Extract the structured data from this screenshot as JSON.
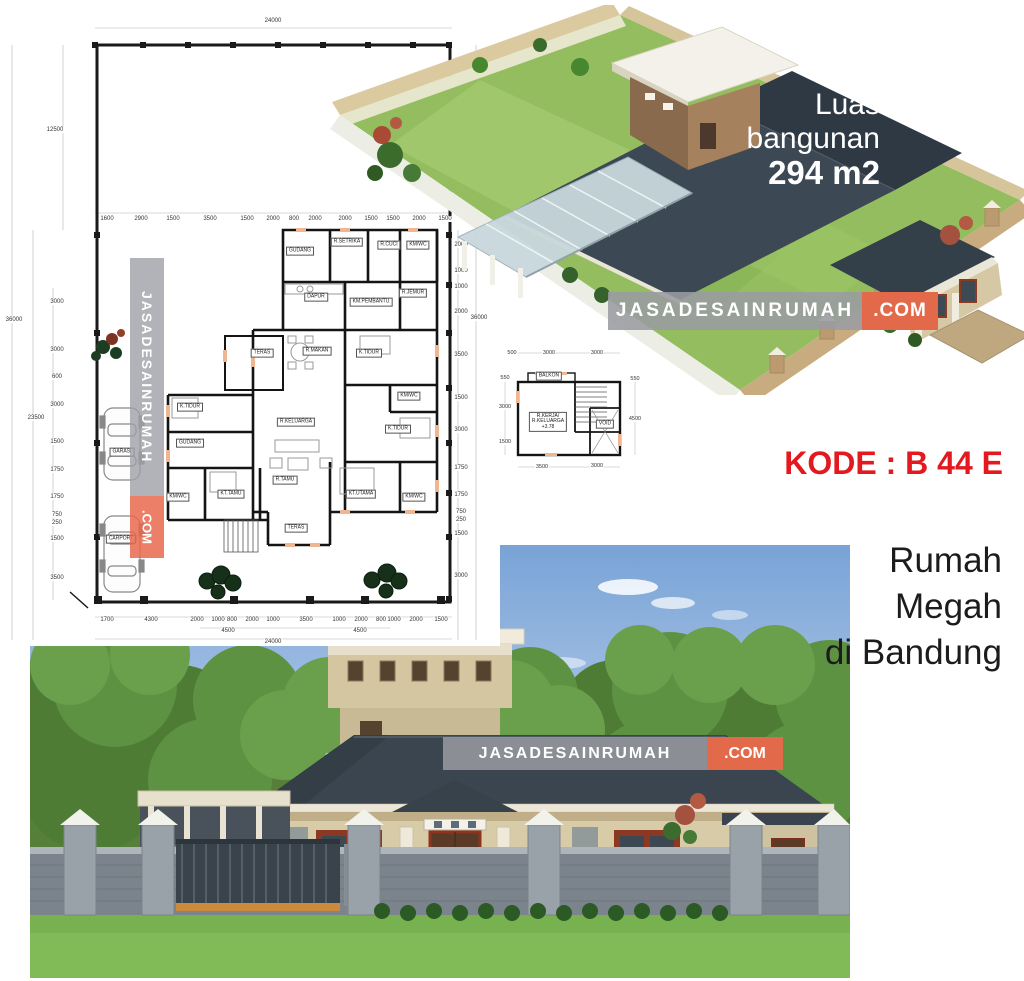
{
  "brand": {
    "name": "JASADESAINRUMAH",
    "tld": ".COM",
    "bar_gray": "#9a9ca2",
    "bar_orange": "#e26a4a"
  },
  "aerial_overlay": {
    "line1": "Luas",
    "line2": "bangunan",
    "line3": "294 m2"
  },
  "code_label": "KODE : B 44 E",
  "code_color": "#e3191f",
  "title_lines": [
    "Rumah",
    "Megah",
    "di Bandung"
  ],
  "main_plan": {
    "rooms": [
      {
        "label": "GUDANG",
        "x": 300,
        "y": 251
      },
      {
        "label": "R.SETRIKA",
        "x": 347,
        "y": 242
      },
      {
        "label": "R.CUCI",
        "x": 389,
        "y": 245
      },
      {
        "label": "KM/WC",
        "x": 418,
        "y": 245
      },
      {
        "label": "DAPUR",
        "x": 316,
        "y": 297
      },
      {
        "label": "KM.PEMBANTU",
        "x": 371,
        "y": 302
      },
      {
        "label": "R.JEMUR",
        "x": 413,
        "y": 293
      },
      {
        "label": "TERAS",
        "x": 262,
        "y": 353
      },
      {
        "label": "R.MAKAN",
        "x": 317,
        "y": 351
      },
      {
        "label": "K.TIDUR",
        "x": 369,
        "y": 353
      },
      {
        "label": "KM/WC",
        "x": 409,
        "y": 396
      },
      {
        "label": "R.KELUARGA",
        "x": 296,
        "y": 422
      },
      {
        "label": "K.TIDUR",
        "x": 398,
        "y": 429
      },
      {
        "label": "K.TIDUR",
        "x": 190,
        "y": 407
      },
      {
        "label": "GUDANG",
        "x": 190,
        "y": 443
      },
      {
        "label": "KM/WC",
        "x": 178,
        "y": 497
      },
      {
        "label": "KT.TAMU",
        "x": 231,
        "y": 494
      },
      {
        "label": "R.TAMU",
        "x": 285,
        "y": 480
      },
      {
        "label": "KT.UTAMA",
        "x": 361,
        "y": 494
      },
      {
        "label": "KM/WC",
        "x": 414,
        "y": 497
      },
      {
        "label": "TERAS",
        "x": 296,
        "y": 528
      },
      {
        "label": "GARASI",
        "x": 122,
        "y": 452
      },
      {
        "label": "CARPORT",
        "x": 121,
        "y": 539
      }
    ],
    "dims": [
      {
        "label": "24000",
        "x": 273,
        "y": 21
      },
      {
        "label": "1600",
        "x": 107,
        "y": 219
      },
      {
        "label": "2900",
        "x": 141,
        "y": 219
      },
      {
        "label": "1500",
        "x": 173,
        "y": 219
      },
      {
        "label": "3500",
        "x": 210,
        "y": 219
      },
      {
        "label": "1500",
        "x": 247,
        "y": 219
      },
      {
        "label": "2000",
        "x": 273,
        "y": 219
      },
      {
        "label": "800",
        "x": 294,
        "y": 219
      },
      {
        "label": "2000",
        "x": 315,
        "y": 219
      },
      {
        "label": "2000",
        "x": 345,
        "y": 219
      },
      {
        "label": "1500",
        "x": 371,
        "y": 219
      },
      {
        "label": "1500",
        "x": 393,
        "y": 219
      },
      {
        "label": "2000",
        "x": 419,
        "y": 219
      },
      {
        "label": "1500",
        "x": 445,
        "y": 219
      },
      {
        "label": "12500",
        "x": 55,
        "y": 130
      },
      {
        "label": "36000",
        "x": 14,
        "y": 320
      },
      {
        "label": "23500",
        "x": 36,
        "y": 418
      },
      {
        "label": "3000",
        "x": 57,
        "y": 302
      },
      {
        "label": "3000",
        "x": 57,
        "y": 350
      },
      {
        "label": "600",
        "x": 57,
        "y": 377
      },
      {
        "label": "3000",
        "x": 57,
        "y": 405
      },
      {
        "label": "1500",
        "x": 57,
        "y": 442
      },
      {
        "label": "1750",
        "x": 57,
        "y": 470
      },
      {
        "label": "1750",
        "x": 57,
        "y": 497
      },
      {
        "label": "750",
        "x": 57,
        "y": 515
      },
      {
        "label": "250",
        "x": 57,
        "y": 523
      },
      {
        "label": "1500",
        "x": 57,
        "y": 539
      },
      {
        "label": "3500",
        "x": 57,
        "y": 578
      },
      {
        "label": "2000",
        "x": 461,
        "y": 245
      },
      {
        "label": "1000",
        "x": 461,
        "y": 271
      },
      {
        "label": "1000",
        "x": 461,
        "y": 287
      },
      {
        "label": "2000",
        "x": 461,
        "y": 312
      },
      {
        "label": "3500",
        "x": 461,
        "y": 355
      },
      {
        "label": "1500",
        "x": 461,
        "y": 398
      },
      {
        "label": "3000",
        "x": 461,
        "y": 430
      },
      {
        "label": "1750",
        "x": 461,
        "y": 468
      },
      {
        "label": "1750",
        "x": 461,
        "y": 495
      },
      {
        "label": "750",
        "x": 461,
        "y": 512
      },
      {
        "label": "250",
        "x": 461,
        "y": 520
      },
      {
        "label": "1500",
        "x": 461,
        "y": 534
      },
      {
        "label": "3000",
        "x": 461,
        "y": 576
      },
      {
        "label": "36000",
        "x": 479,
        "y": 318
      },
      {
        "label": "1700",
        "x": 107,
        "y": 620
      },
      {
        "label": "4300",
        "x": 151,
        "y": 620
      },
      {
        "label": "2000",
        "x": 197,
        "y": 620
      },
      {
        "label": "1000",
        "x": 218,
        "y": 620
      },
      {
        "label": "800",
        "x": 232,
        "y": 620
      },
      {
        "label": "2000",
        "x": 252,
        "y": 620
      },
      {
        "label": "1000",
        "x": 273,
        "y": 620
      },
      {
        "label": "3500",
        "x": 306,
        "y": 620
      },
      {
        "label": "1000",
        "x": 339,
        "y": 620
      },
      {
        "label": "2000",
        "x": 361,
        "y": 620
      },
      {
        "label": "800",
        "x": 381,
        "y": 620
      },
      {
        "label": "1000",
        "x": 394,
        "y": 620
      },
      {
        "label": "2000",
        "x": 416,
        "y": 620
      },
      {
        "label": "1500",
        "x": 441,
        "y": 620
      },
      {
        "label": "4500",
        "x": 228,
        "y": 631
      },
      {
        "label": "4500",
        "x": 360,
        "y": 631
      },
      {
        "label": "24000",
        "x": 273,
        "y": 642
      }
    ]
  },
  "upper_plan": {
    "rooms": [
      {
        "label": "BALKON",
        "x": 54,
        "y": 40
      },
      {
        "label": "R.KERJA/\nR.KELUARGA\n+3.78",
        "x": 53,
        "y": 86
      },
      {
        "label": "VOID",
        "x": 110,
        "y": 88
      }
    ],
    "dims": [
      {
        "label": "500",
        "x": 17,
        "y": 17
      },
      {
        "label": "3000",
        "x": 54,
        "y": 17
      },
      {
        "label": "3000",
        "x": 102,
        "y": 17
      },
      {
        "label": "550",
        "x": 10,
        "y": 42
      },
      {
        "label": "3000",
        "x": 10,
        "y": 71
      },
      {
        "label": "1500",
        "x": 10,
        "y": 106
      },
      {
        "label": "550",
        "x": 140,
        "y": 43
      },
      {
        "label": "4500",
        "x": 140,
        "y": 83
      },
      {
        "label": "3500",
        "x": 47,
        "y": 131
      },
      {
        "label": "3000",
        "x": 102,
        "y": 130
      }
    ]
  }
}
